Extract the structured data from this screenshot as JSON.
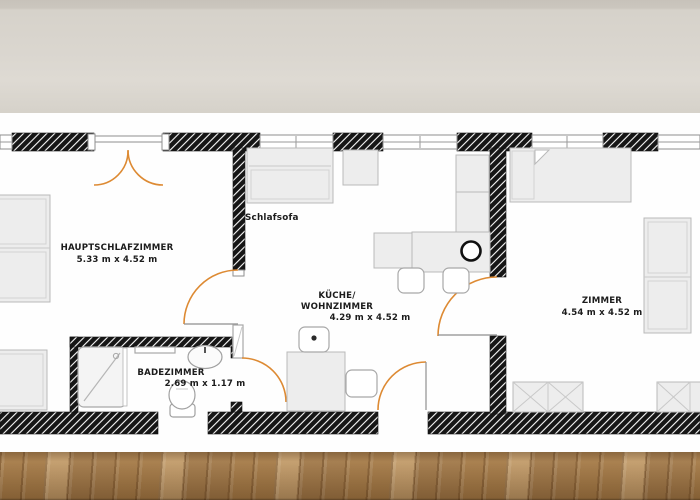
{
  "scene": {
    "description": "apartment floor plan rendered on a white sheet, photographed against a beige wall above a wooden plank floor"
  },
  "rooms": [
    {
      "id": "hauptschlafzimmer",
      "label": "HAUPTSCHLAFZIMMER",
      "dimensions": "5.33 m x 4.52 m"
    },
    {
      "id": "kueche-wohnzimmer",
      "label_line1": "KÜCHE/",
      "label_line2": "WOHNZIMMER",
      "dimensions": "4.29 m x 4.52 m"
    },
    {
      "id": "zimmer",
      "label": "ZIMMER",
      "dimensions": "4.54 m x 4.52 m"
    },
    {
      "id": "badezimmer",
      "label": "BADEZIMMER",
      "dimensions": "2.69 m x 1.17 m"
    }
  ],
  "annotations": {
    "schlafsofa": "Schlafsofa"
  },
  "colors": {
    "door_swing": "#dd8a33",
    "wall_fill": "#161616",
    "wall_hatch": "#fafafa",
    "furniture_fill": "#ededed",
    "furniture_stroke": "#b9b9b9",
    "label_text": "#1c1c1c",
    "backdrop_wall": "#d8d4cc",
    "plan_sheet": "#fefefe",
    "floor_wood": "#b58c58"
  }
}
